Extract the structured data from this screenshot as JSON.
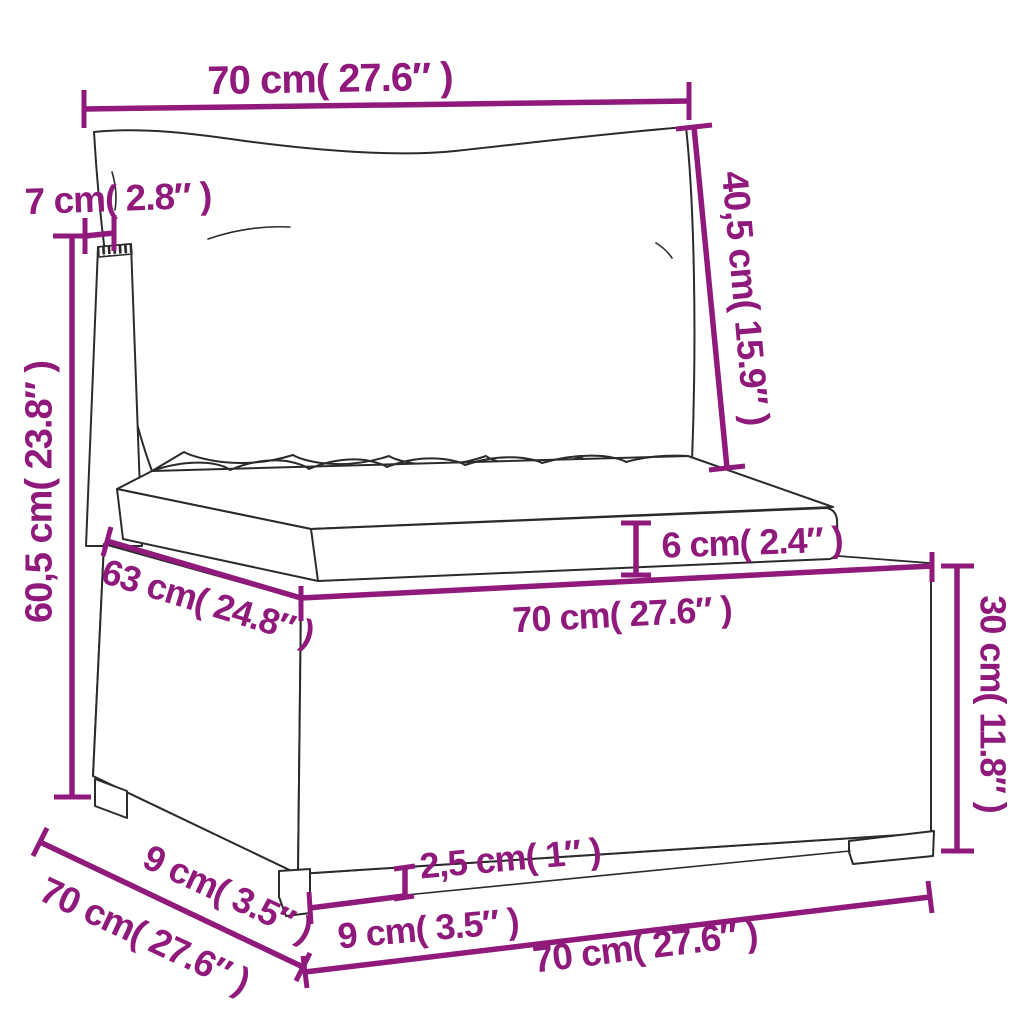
{
  "diagram": {
    "colors": {
      "accent": "#8F1A7B",
      "line_art": "#2b2b2b",
      "background": "#ffffff"
    },
    "dimensions": {
      "top_width": "70 cm( 27.6″ )",
      "back_thickness": "7 cm( 2.8″ )",
      "back_cushion_height": "40,5 cm( 15.9″ )",
      "total_height": "60,5 cm( 23.8″ )",
      "seat_cushion_thickness": "6 cm( 2.4″ )",
      "seat_depth": "63 cm( 24.8″ )",
      "seat_width": "70 cm( 27.6″ )",
      "base_height": "30 cm( 11.8″ )",
      "side_leg_inset": "9 cm( 3.5″ )",
      "total_depth": "70 cm( 27.6″ )",
      "front_leg_inset": "9 cm( 3.5″ )",
      "leg_height": "2,5 cm( 1″ )",
      "bottom_front_width": "70 cm( 27.6″ )"
    }
  }
}
